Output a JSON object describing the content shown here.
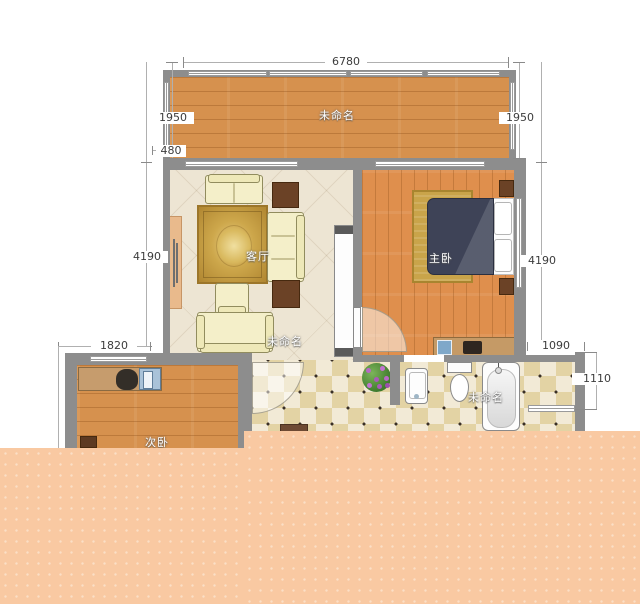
{
  "plan": {
    "rooms": {
      "balcony": {
        "label": "未命名"
      },
      "living": {
        "label": "客厅"
      },
      "living_area": {
        "label": "未命名"
      },
      "master_bedroom": {
        "label": "主卧"
      },
      "second_bedroom": {
        "label": "次卧"
      },
      "bathroom": {
        "label": "未命名"
      }
    },
    "dimensions": {
      "balcony_width": "6780",
      "balcony_side_left": "1950",
      "balcony_side_right": "1950",
      "wall_offset": "480",
      "left_height": "4190",
      "right_height": "4190",
      "second_bedroom_width": "1820",
      "bathroom_width": "1090",
      "bathroom_height": "1110"
    },
    "colors": {
      "wall": "#8d8d8d",
      "balcony_wood": "#d6914e",
      "bedroom_wood": "#df8f4d",
      "living_floor": "#ede5d3",
      "tile_light": "#f2ead6",
      "tile_dark": "#e3d3a4",
      "rug_gold": "#c9a44a",
      "bed_navy": "#3e4357",
      "sofa_cream": "#f4efc9",
      "overlay_peach": "#f9c9a2"
    }
  }
}
